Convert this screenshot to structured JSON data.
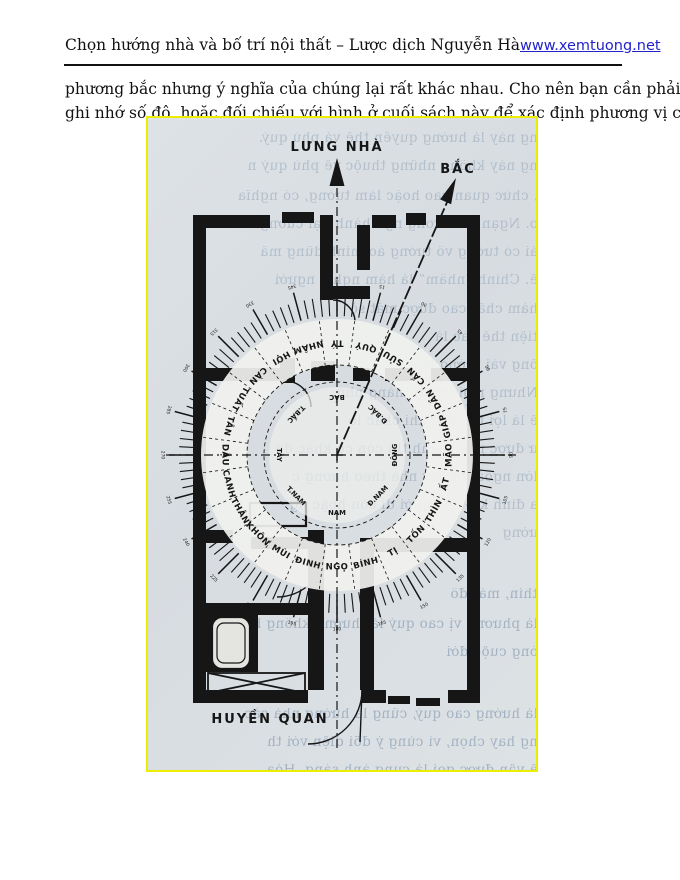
{
  "header": {
    "title": "Chọn hướng nhà và bố trí nội thất – Lược dịch Nguyễn Hà",
    "link": "www.xemtuong.net",
    "page_number": "29"
  },
  "paragraph": {
    "lines": [
      "phương bắc nhưng ý nghĩa của chúng lại rất khác nhau. Cho nên bạn cần phải dùng la bàn và",
      "ghi nhớ số độ, hoặc đối chiếu với hình ở cuối sách này để xác định phương vị cho chính xác."
    ]
  },
  "figure": {
    "labels": {
      "back_of_house": "LƯNG NHÀ",
      "north": "BẮC",
      "entrance": "HUYỀN QUAN"
    },
    "compass": {
      "ring_24": [
        "TÝ",
        "QUÝ",
        "SỬU",
        "CẤN",
        "DẦN",
        "GIÁP",
        "MÃO",
        "ẤT",
        "THÌN",
        "TỐN",
        "TỊ",
        "BÍNH",
        "NGỌ",
        "ĐINH",
        "MÙI",
        "KHÔN",
        "THÂN",
        "CANH",
        "DẬU",
        "TÂN",
        "TUẤT",
        "CÀN",
        "HỢI",
        "NHÂM"
      ],
      "inner_8": [
        "BẮC",
        "Đ.BẮC",
        "ĐÔNG",
        "Đ.NAM",
        "NAM",
        "T.NAM",
        "TÂY",
        "T.BẮC"
      ],
      "degree_labels": [
        "0",
        "15",
        "30",
        "45",
        "60",
        "75",
        "90",
        "105",
        "120",
        "135",
        "150",
        "165",
        "180",
        "195",
        "210",
        "225",
        "240",
        "255",
        "270",
        "285",
        "300",
        "315",
        "330",
        "345"
      ],
      "needle_angle_deg": 24
    },
    "bleed_text_lines": [
      "ng này là hướng quyền thế và phú quý.",
      "ng này không những thuộc về phú quý n",
      ", chức quan cao hoặc làm tướng, có nghĩa",
      "o. Ngạn xưa trong ngũ hành đại cương",
      "ải có tướng võ tướng áo minh dũng mã",
      "ế. Chính “nhâm” là hàm nghĩa người",
      "hàm chất cao được mặt số",
      "tiện thế các là",
      "ống vài tướng là",
      "Nhưng mọi trong tháng phủ",
      "ế là lợi thế các khi chắc lò",
      "ư được nhờ thành thì còn có khác đó",
      "lớn ngoài ra xây nhà theo hướng c",
      "a đình khi có người di còn hoặc ng",
      "ường",
      "thín, mát đô",
      "là phương vị cao quý là thường không bỏ",
      "óng cuộc đời",
      "là hướng cao quý, cũng là hướng nhà các",
      "ng hay chọn, vì cùng ý đổi diện với th",
      "ế-vận được gọi là cung ánh sáng. Hỏa"
    ],
    "colors": {
      "scan_background": "#dadfe3",
      "scan_border": "#eded00",
      "ink": "#161616",
      "bleed_text": "#94a7ba",
      "link_blue": "#2323cc"
    }
  }
}
